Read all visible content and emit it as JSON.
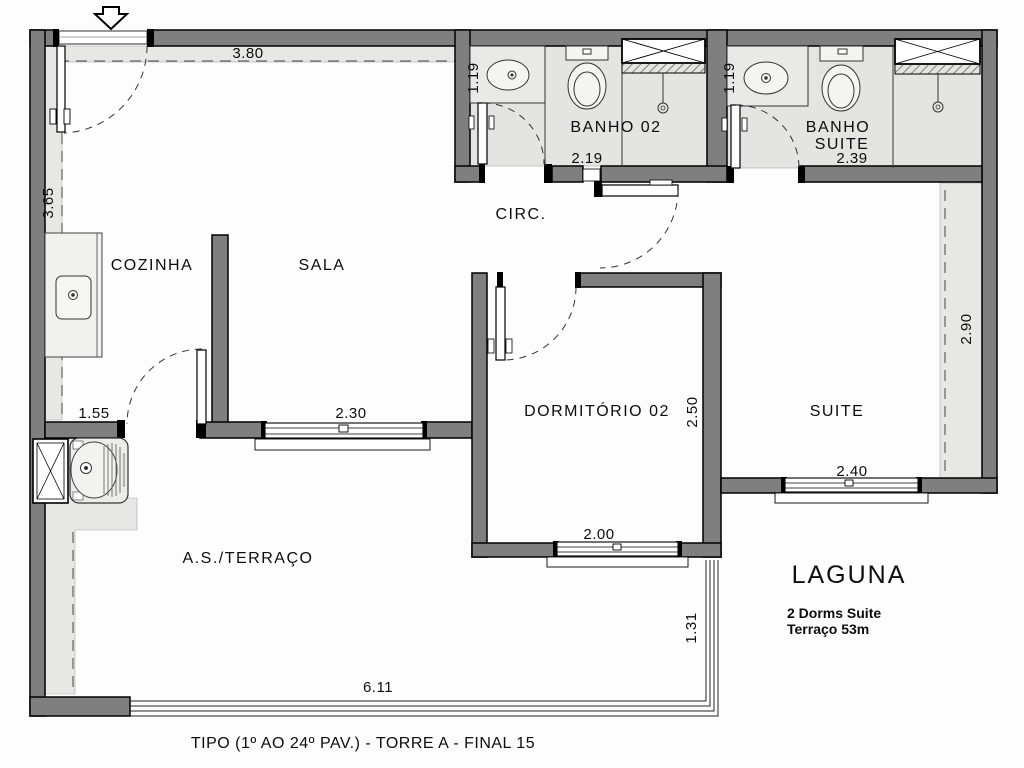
{
  "plan": {
    "rooms": {
      "cozinha": "COZINHA",
      "sala": "SALA",
      "banho02": "BANHO  02",
      "banho_suite_l1": "BANHO",
      "banho_suite_l2": "SUITE",
      "circ": "CIRC.",
      "dormitorio02": "DORMITÓRIO  02",
      "suite": "SUITE",
      "as_terraco": "A.S./TERRAÇO"
    },
    "dims": {
      "top": "3.80",
      "left": "3.65",
      "banho02_w": "1.19",
      "banho02_len": "2.19",
      "banho_suite_w": "1.19",
      "banho_suite_len": "2.39",
      "kitchen_pass": "1.55",
      "sala_window": "2.30",
      "dorm_depth": "2.50",
      "dorm_window": "2.00",
      "suite_depth": "2.90",
      "suite_window": "2.40",
      "terrace_depth": "1.31",
      "terrace_len": "6.11"
    },
    "legend": {
      "title": "LAGUNA",
      "line1": "2 Dorms Suite",
      "line2": "Terraço 53m"
    },
    "caption": "TIPO (1º AO 24º PAV.) - TORRE A - FINAL 15"
  }
}
